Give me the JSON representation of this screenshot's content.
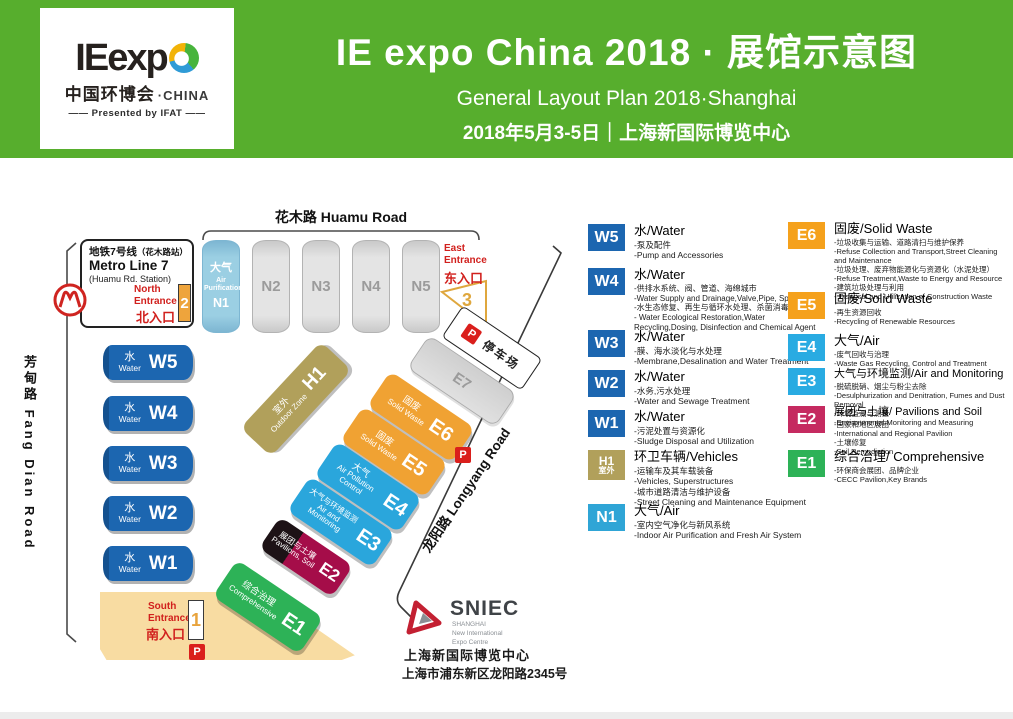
{
  "banner": {
    "logo": {
      "wordmark": "IEexp",
      "cn": "中国环博会",
      "cn_suffix": "·CHINA",
      "presented": "—— Presented by IFAT ——"
    },
    "title": "IE expo China 2018 · 展馆示意图",
    "subtitle": "General Layout Plan 2018·Shanghai",
    "date_line": "2018年5月3-5日｜上海新国际博览中心"
  },
  "map": {
    "roads": {
      "huamu": "花木路 Huamu Road",
      "fangdian": "芳甸路 Fang Dian Road",
      "longyang": "龙阳路 Longyang Road"
    },
    "metro": {
      "line_cn": "地铁7号线",
      "station_cn": "（花木路站）",
      "line_en": "Metro Line 7",
      "station_en": "(Huamu Rd. Station)"
    },
    "entrances": {
      "north": {
        "en": "North Entrance",
        "cn": "北入口",
        "num": "2"
      },
      "east": {
        "en": "East Entrance",
        "cn": "东入口",
        "num": "3"
      },
      "south": {
        "en": "South Entrance",
        "cn": "南入口",
        "num": "1"
      }
    },
    "n_halls": [
      {
        "code": "N1",
        "cn": "大气",
        "en": "Air Purification"
      },
      {
        "code": "N2"
      },
      {
        "code": "N3"
      },
      {
        "code": "N4"
      },
      {
        "code": "N5"
      }
    ],
    "w_halls": [
      {
        "code": "W5",
        "cn": "水",
        "en": "Water"
      },
      {
        "code": "W4",
        "cn": "水",
        "en": "Water"
      },
      {
        "code": "W3",
        "cn": "水",
        "en": "Water"
      },
      {
        "code": "W2",
        "cn": "水",
        "en": "Water"
      },
      {
        "code": "W1",
        "cn": "水",
        "en": "Water"
      }
    ],
    "e_halls": [
      {
        "code": "H1",
        "cn": "室外",
        "en": "Outdoor Zone"
      },
      {
        "code": "E7"
      },
      {
        "code": "E6",
        "cn": "固废",
        "en": "Solid Waste"
      },
      {
        "code": "E5",
        "cn": "固废",
        "en": "Solid Waste"
      },
      {
        "code": "E4",
        "cn": "大气",
        "en": "Air Pollution Control"
      },
      {
        "code": "E3",
        "cn": "大气与环境监测",
        "en": "Air and Monitoring"
      },
      {
        "code": "E2",
        "cn": "展团与土壤",
        "en": "Pavilions, Soil"
      },
      {
        "code": "E1",
        "cn": "综合治理",
        "en": "Comprehensive"
      }
    ],
    "parking": {
      "label": "停车场"
    },
    "p_label": "P",
    "sniec": {
      "name": "SNIEC",
      "sub1": "SHANGHAI",
      "sub2": "New International",
      "sub3": "Expo Centre"
    },
    "address": {
      "line1": "上海新国际博览中心",
      "line2": "上海市浦东新区龙阳路2345号"
    }
  },
  "legend": {
    "left": [
      {
        "code": "W5",
        "title": "水/Water",
        "lines": [
          "-泵及配件",
          "-Pump and Accessories"
        ]
      },
      {
        "code": "W4",
        "title": "水/Water",
        "lines": [
          "-供排水系统、阀、管道、海绵城市",
          "-Water Supply and Drainage,Valve,Pipe, Sponge City",
          "-水生态修复、再生与循环水处理、杀菌消毒、化学品",
          "- Water Ecological Restoration,Water Recycling,Dosing, Disinfection and Chemical Agent"
        ]
      },
      {
        "code": "W3",
        "title": "水/Water",
        "lines": [
          "-膜、海水淡化与水处理",
          "-Membrane,Desalination and Water Treatment"
        ]
      },
      {
        "code": "W2",
        "title": "水/Water",
        "lines": [
          "-水务,污水处理",
          "-Water and Sewage Treatment"
        ]
      },
      {
        "code": "W1",
        "title": "水/Water",
        "lines": [
          "-污泥处置与资源化",
          "-Sludge Disposal and Utilization"
        ]
      },
      {
        "code": "H1",
        "code_sub": "室外",
        "title": "环卫车辆/Vehicles",
        "lines": [
          "-运输车及其车载装备",
          "-Vehicles, Superstructures",
          "-城市道路清洁与维护设备",
          "-Street Cleaning and Maintenance Equipment"
        ]
      },
      {
        "code": "N1",
        "title": "大气/Air",
        "lines": [
          "-室内空气净化与新风系统",
          "-Indoor Air Purification and Fresh Air System"
        ]
      }
    ],
    "right": [
      {
        "code": "E6",
        "title": "固废/Solid Waste",
        "lines": [
          "-垃圾收集与运输、道路清扫与维护保养",
          "-Refuse Collection and Transport,Street Cleaning and Maintenance",
          "-垃圾处理、废弃物能源化与资源化（水泥处理）",
          "-Refuse Treatment,Waste to Energy and Resource",
          "-建筑垃圾处理与利用",
          "- Disposal and Utilization of Construction Waste"
        ]
      },
      {
        "code": "E5",
        "title": "固废/Solid Waste",
        "lines": [
          "-再生资源回收",
          "-Recycling of Renewable Resources"
        ]
      },
      {
        "code": "E4",
        "title": "大气/Air",
        "lines": [
          "-废气回收与治理",
          "-Waste Gas Recycling, Control and Treatment"
        ]
      },
      {
        "code": "E3",
        "title": "大气与环境监测/Air and Monitoring",
        "lines": [
          "-脱硫脱硝、烟尘与粉尘去除",
          "-Desulphurization and Denitration, Fumes and Dust Removal",
          "-环境监测与测量",
          "-Environmental Monitoring and Measuring"
        ]
      },
      {
        "code": "E2",
        "title": "展团与土壤/ Pavilions and Soil",
        "lines": [
          "-国家和地区展团",
          "-International and Regional Pavilion",
          "-土壤修复",
          "-Soil Remediation"
        ]
      },
      {
        "code": "E1",
        "title": "综合治理/ Comprehensive",
        "lines": [
          "-环保商会展团、品牌企业",
          "-CECC Pavilion,Key Brands"
        ]
      }
    ]
  },
  "colors": {
    "banner_green": "#57ae2d",
    "water_blue": "#1c66b0",
    "air_blue": "#29abe2",
    "solid_waste_orange": "#f5a11c",
    "outdoor_tan": "#b1a05b",
    "pavilion_crimson": "#a50d49",
    "comprehensive_green": "#2db257",
    "n1_light_blue": "#9bcfe3",
    "entrance_red": "#d1201d",
    "parking_red": "#da1f1c",
    "south_zone_beige": "#f8dca2"
  }
}
